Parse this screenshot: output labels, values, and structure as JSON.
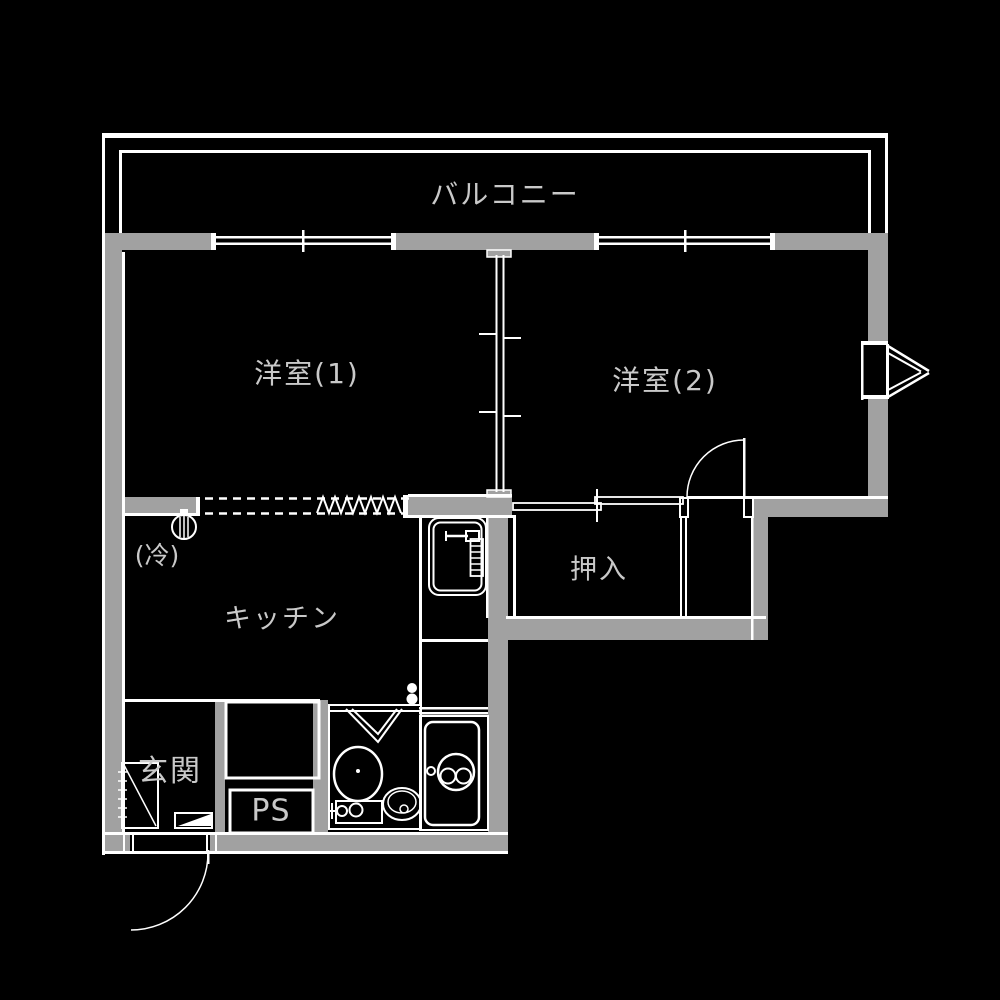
{
  "title": "floor-plan",
  "colors": {
    "background": "#000000",
    "wall": "#a1a1a1",
    "line": "#ffffff",
    "label": "#c9c9c9"
  },
  "rooms": {
    "balcony": {
      "label": "バルコニー"
    },
    "western1": {
      "label": "洋室(1)"
    },
    "western2": {
      "label": "洋室(2)"
    },
    "closet": {
      "label": "押入"
    },
    "kitchen": {
      "label": "キッチン"
    },
    "entrance": {
      "label": "玄関"
    },
    "pipe_space": {
      "label": "PS"
    },
    "refrigerator": {
      "label": "(冷)"
    }
  }
}
